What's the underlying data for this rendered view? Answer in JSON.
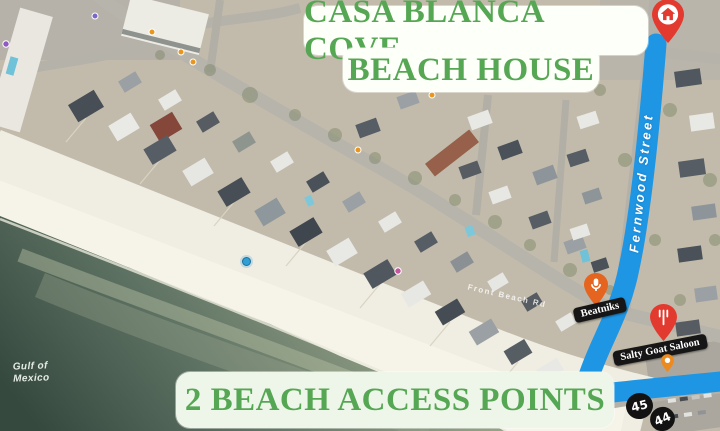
{
  "title": {
    "line1": "CASA BLANCA COVE",
    "line2": "BEACH HOUSE"
  },
  "footer": {
    "label": "2 BEACH ACCESS POINTS"
  },
  "theme": {
    "banner_text_color": "#56a754",
    "banner_bg": "#fdfff9",
    "route_color": "#1f96e3",
    "pin_red": "#e23a2e",
    "pin_orange": "#e5641f",
    "mini_pin_orange": "#ec8a1e",
    "water_deep": "#36493f",
    "water_shallow": "#98a488",
    "sand": "#f1eee3"
  },
  "map": {
    "water_label_lines": [
      "Gulf of",
      "Mexico"
    ],
    "street_label": "Fernwood Street",
    "road_label": "Front Beach Rd",
    "location_dot_color": "#2f9fd4",
    "destination": {
      "icon": "home-pin",
      "pin_color": "#e23a2e"
    },
    "pois": [
      {
        "name": "Beatniks",
        "icon": "microphone-pin",
        "pin_color": "#e5641f"
      },
      {
        "name": "Salty Goat Saloon",
        "icon": "restaurant-pin",
        "pin_color": "#e23a2e"
      }
    ],
    "route_shields": [
      {
        "label": "45"
      },
      {
        "label": "44"
      }
    ]
  }
}
